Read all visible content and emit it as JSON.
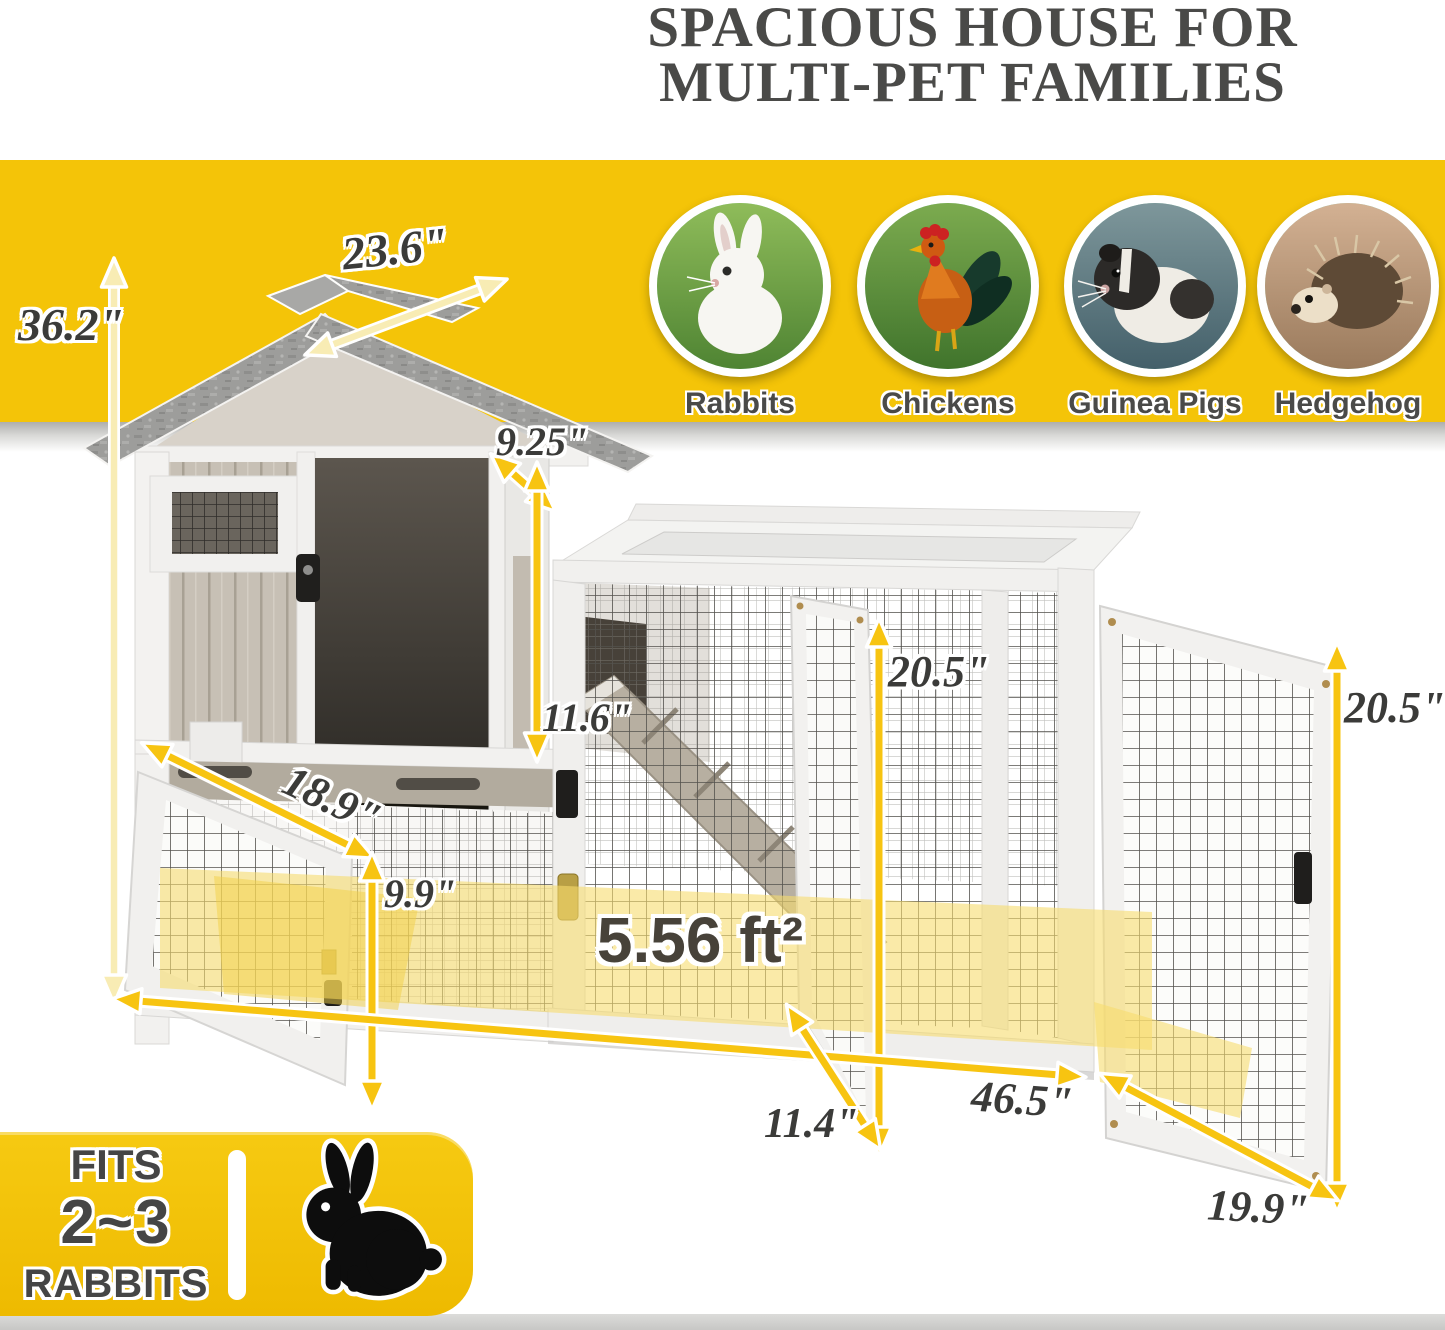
{
  "header": {
    "title_line1": "SPACIOUS HOUSE FOR",
    "title_line2": "MULTI-PET FAMILIES"
  },
  "pets": {
    "items": [
      {
        "label": "Rabbits"
      },
      {
        "label": "Chickens"
      },
      {
        "label": "Guinea Pigs"
      },
      {
        "label": "Hedgehog"
      }
    ]
  },
  "dimensions": {
    "roof_width": "23.6\"",
    "total_height": "36.2\"",
    "upper_door_width": "9.25\"",
    "upper_door_height": "11.6\"",
    "run_inner_height": "20.5\"",
    "right_door_height": "20.5\"",
    "lower_depth": "18.9\"",
    "lower_height": "9.9\"",
    "floor_area": "5.56 ft²",
    "middle_door_width": "11.4\"",
    "total_length": "46.5\"",
    "right_door_width": "19.9\""
  },
  "badge": {
    "line1": "FITS",
    "line2": "2~3",
    "line3": "RABBITS"
  },
  "colors": {
    "banner_yellow": "#F4C408",
    "badge_yellow": "#EEBA00",
    "arrow_yellow": "#F7C411",
    "pale_arrow_fill": "#F8ECB4",
    "highlight_yellow": "#F6DC6E",
    "title_text": "#4A4A48",
    "label_text": "#3B3B39"
  }
}
